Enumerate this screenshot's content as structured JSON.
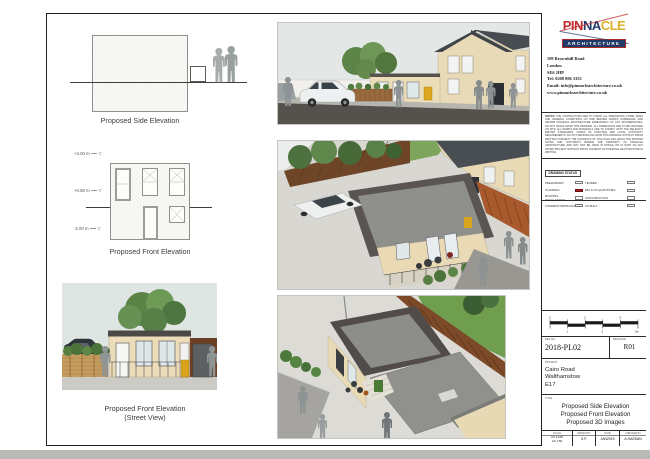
{
  "colors": {
    "accent_red": "#a81e22",
    "logo_red": "#c0272d",
    "logo_navy": "#223a66",
    "logo_gold": "#d9b12a",
    "sheet_border": "#1f1f1f"
  },
  "title_block": {
    "logo": {
      "part1": "PIN",
      "part2": "NA",
      "part3": "CLE",
      "subtitle": "ARCHITECTURE",
      "tagline": "ARCHITECTURAL DESIGN - STRUCTURAL DESIGN - QUANTITY SURVEYORS"
    },
    "address_lines": {
      "l1": "109 Brownhill Road",
      "l2": "London",
      "l3": "SE6 2HP",
      "l4": "Tel: 0208 806 5353",
      "l5": "Email: info@pinnaclearchitecture.co.uk",
      "l6": "www.pinnaclearchitecture.co.uk"
    },
    "notes": {
      "heading": "NOTES:",
      "body": "THE CONTRACTORS ARE TO CHECK ALL DIMENSIONS, FORM, SIZES AND GENERAL CONDITIONS ON SITE BEFORE WORKS COMMENCE, AND INFORM PINNACLE ARCHITECTURE IMMEDIATELY OF ANY DISCREPANCIES. DO NOT SCALE FROM THIS DRAWING. ALL DIMENSIONS ARE TO BE CHECKED ON SITE. ALL WORKS AND MATERIALS ARE TO COMPLY WITH THE RELEVANT BRITISH STANDARDS, CODES OF PRACTICE AND LOCAL AUTHORITY REQUIREMENTS. DO NOT REPRODUCE FROM THIS DRAWING WITHOUT PRIOR WRITTEN CONSENT. THE CONTENTS OF THIS PLAN INCLUDING THE PRINTED NOTES AND COPYRIGHT REMAIN THE PROPERTY OF PINNACLE ARCHITECTURE AND MAY NOT BE USED IN WHOLE OR IN PART ON ANY OTHER PROJECT WITHOUT PRIOR CONSENT OF PINNACLE ARCHITECTURE IN WRITING."
    },
    "drawing_status": {
      "heading": "DRAWING STATUS",
      "rows": [
        {
          "left": "PRELIMINARY",
          "right": "TENDER"
        },
        {
          "left": "PLANNING",
          "right": "BILLS OF QUANTITIES"
        },
        {
          "left": "BUILDING REGULATIONS",
          "right": "CONSTRUCTION"
        },
        {
          "left": "COMMENT/APPROVAL",
          "right": "AS BUILT"
        }
      ],
      "checked_item": "PLANNING",
      "checked_color": "#a81e22"
    },
    "scale_bar": {
      "ticks": [
        "0",
        "1",
        "2",
        "3",
        "4",
        "5m"
      ]
    },
    "ref": {
      "label": "REF NO",
      "value": "2018-PL02"
    },
    "revision": {
      "label": "REVISION",
      "value": "R01"
    },
    "project": {
      "label": "PROJECT",
      "line1": "Cairo Road",
      "line2": "Walthamstow",
      "line3": "E17"
    },
    "title": {
      "label": "TITLE",
      "line1": "Proposed Side Elevation",
      "line2": "Proposed Front Elevation",
      "line3": "Proposed 3D Images"
    },
    "info_row": {
      "scale_label": "SCALE",
      "scale_line1": "A3  1:100",
      "scale_line2": "A4  1:50",
      "drawn_label": "DRAWN BY",
      "drawn_value": "S.P.",
      "date_label": "DATE",
      "date_value": "JAN2019",
      "checked_label": "CHECKED BY",
      "checked_value": "A.HASSAN"
    }
  },
  "drawings": {
    "side_elevation": {
      "caption": "Proposed Side Elevation"
    },
    "front_elevation": {
      "caption": "Proposed Front Elevation",
      "levels": [
        "+3.00 m",
        "+0.50 m",
        "-2.00 m"
      ],
      "level_symbol": "▽"
    },
    "street_view": {
      "caption_line1": "Proposed Front Elevation",
      "caption_line2": "(Street View)"
    }
  }
}
